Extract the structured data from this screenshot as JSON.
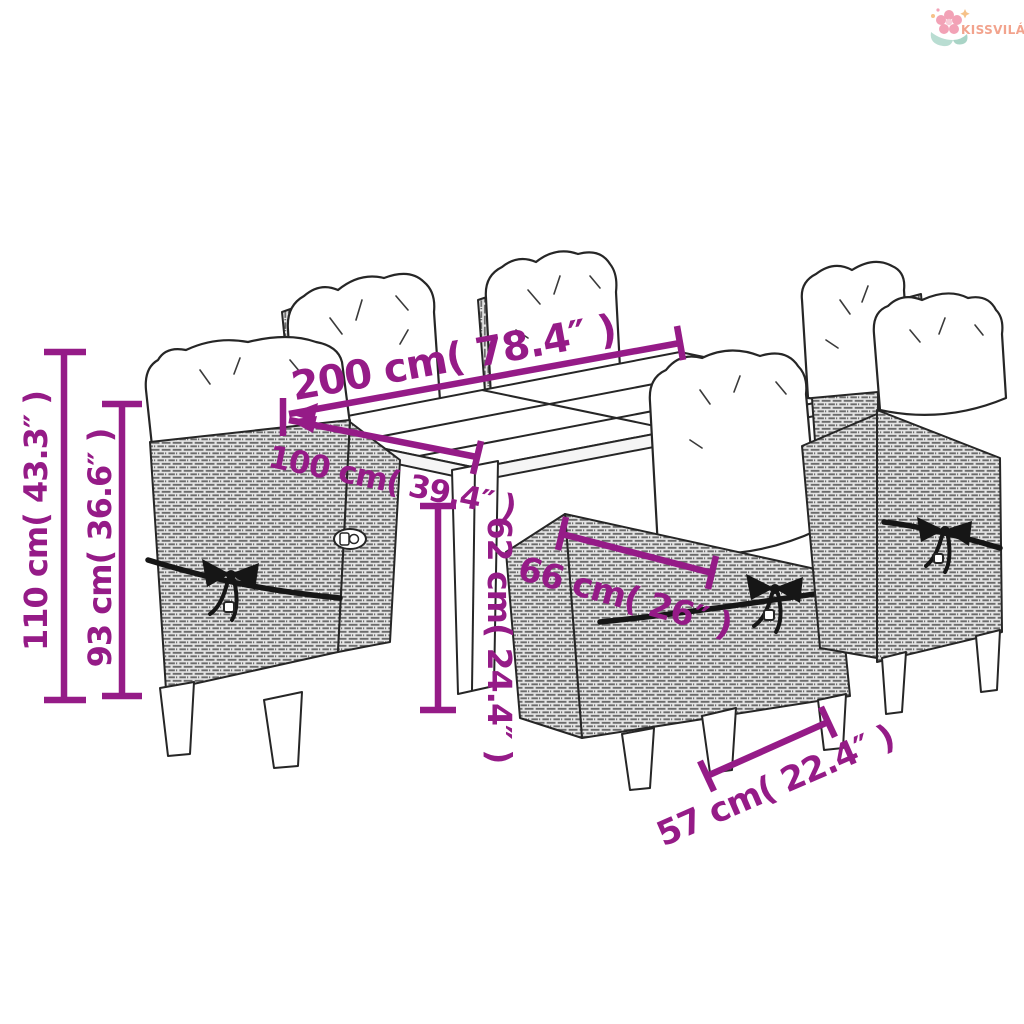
{
  "logo": {
    "brand": "KISSVILÁG"
  },
  "dimensions": {
    "table_length": {
      "label": "200 cm( 78.4″ )",
      "cm": 200,
      "inches": 78.4
    },
    "table_width": {
      "label": "100 cm( 39.4″ )",
      "cm": 100,
      "inches": 39.4
    },
    "table_height": {
      "label": "62 cm( 24.4″ )",
      "cm": 62,
      "inches": 24.4
    },
    "chair_back_width": {
      "label": "66 cm( 26″ )",
      "cm": 66,
      "inches": 26
    },
    "chair_width": {
      "label": "57 cm( 22.4″ )",
      "cm": 57,
      "inches": 22.4
    },
    "chair_height": {
      "label": "110 cm( 43.3″ )",
      "cm": 110,
      "inches": 43.3
    },
    "backrest_height": {
      "label": "93 cm( 36.6″ )",
      "cm": 93,
      "inches": 36.6
    }
  },
  "colors": {
    "dimension_text": "#951b87",
    "brand_text": "#f2a38d",
    "outline": "#262626",
    "background": "#ffffff"
  },
  "scene": {
    "description": "9-piece garden dining set: rattan table with 6 reclining wicker chairs with white cushions"
  }
}
